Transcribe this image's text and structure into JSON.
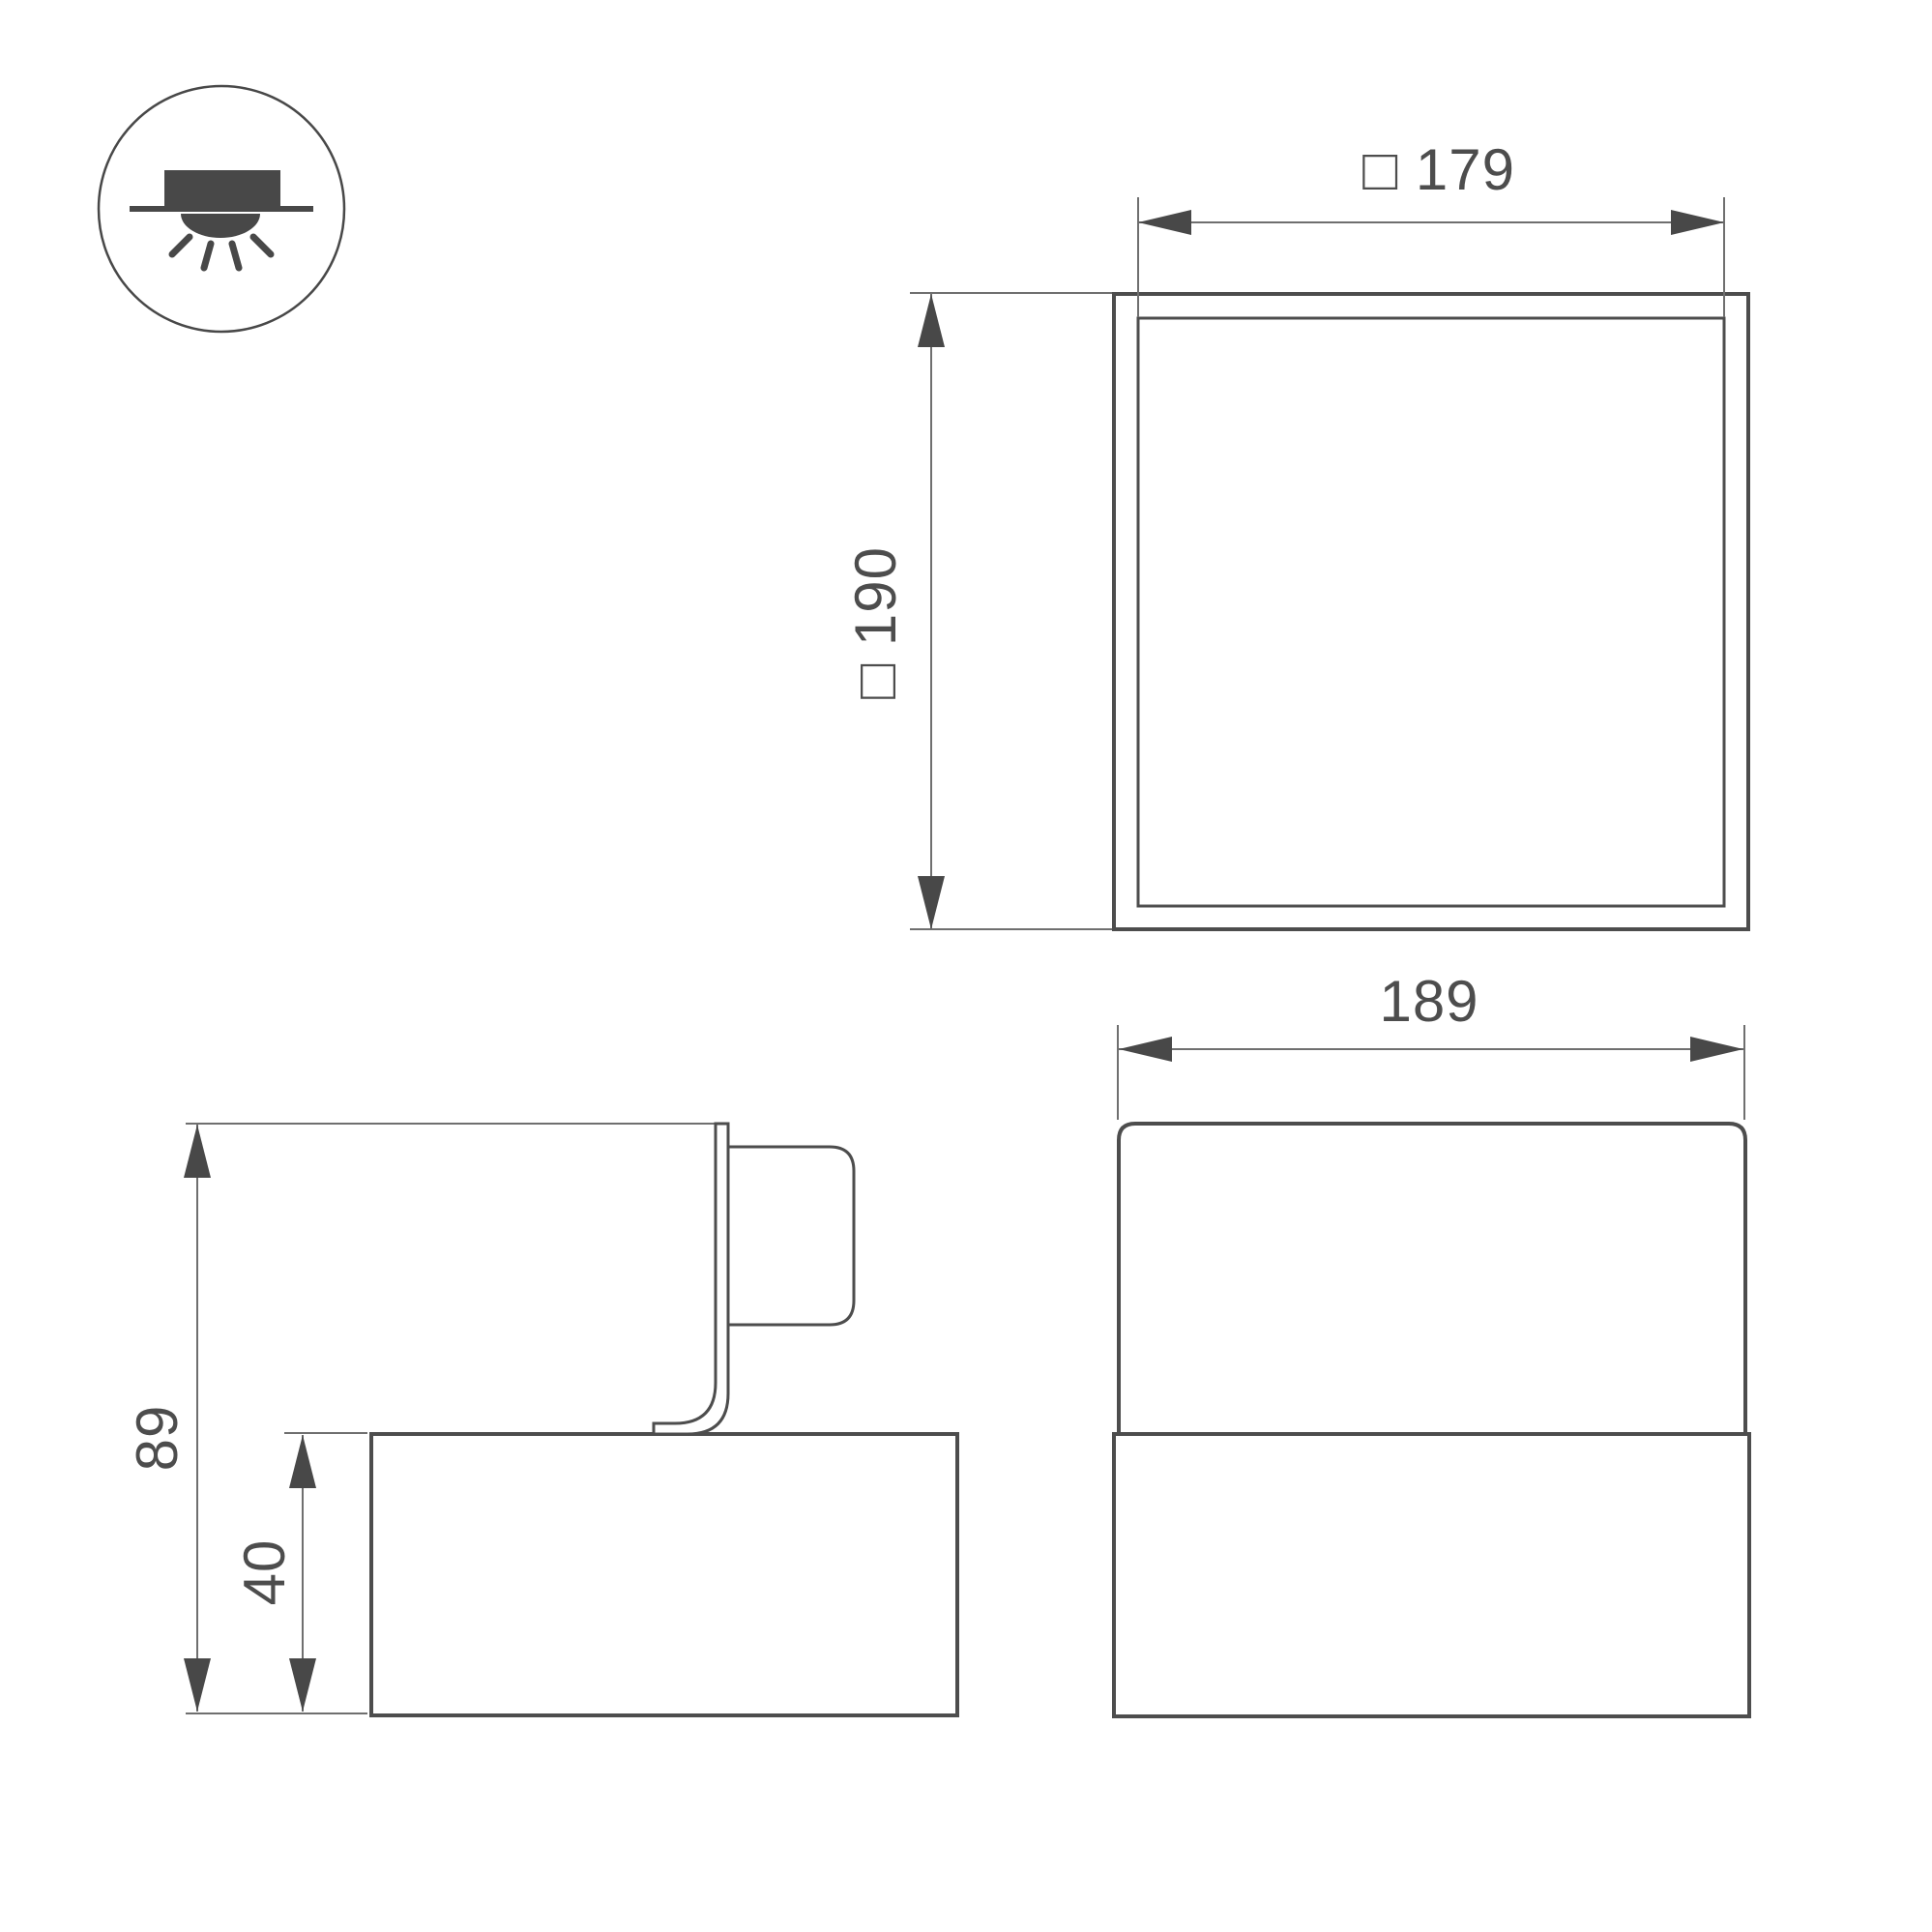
{
  "colors": {
    "background": "#ffffff",
    "outline": "#4d4d4d",
    "dimension": "#6f6f6f",
    "arrow": "#484848",
    "text": "#4d4d4d"
  },
  "icon": {
    "name": "surface-ceiling-mount-downlight"
  },
  "labels": {
    "top_view_outer_size": "□ 190",
    "top_view_inner_size": "□ 179",
    "front_view_width": "189",
    "side_view_total_height": "89",
    "side_view_base_height": "40"
  }
}
